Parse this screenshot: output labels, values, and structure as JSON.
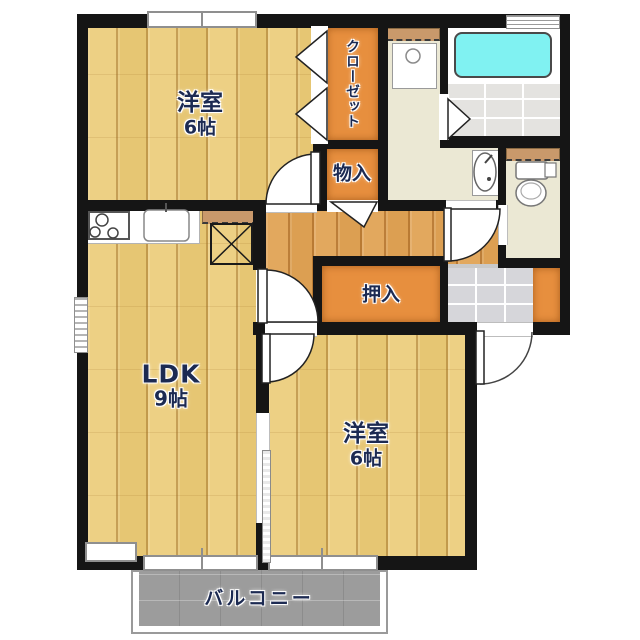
{
  "plan_title": "2LDK apartment floor plan",
  "rooms": {
    "bedroom1": {
      "label": "洋室",
      "size": "6帖"
    },
    "bedroom2": {
      "label": "洋室",
      "size": "6帖"
    },
    "ldk": {
      "label": "LDK",
      "size": "9帖"
    },
    "closet": {
      "label": "クローゼット"
    },
    "storage": {
      "label": "物入"
    },
    "oshiire": {
      "label": "押入"
    },
    "balcony": {
      "label": "バルコニー"
    }
  },
  "colors": {
    "wood": "#edd084",
    "hall_wood": "#e2a85e",
    "closet_orange": "#e78f3e",
    "cream": "#ebe8d4",
    "bath_tile": "#e4e3e0",
    "entry_tile": "#d6d6da",
    "balcony_gray": "#9c9c9c",
    "bathtub_cyan": "#80f2f2",
    "label_navy": "#1c2a52",
    "wall_black": "#151515"
  }
}
